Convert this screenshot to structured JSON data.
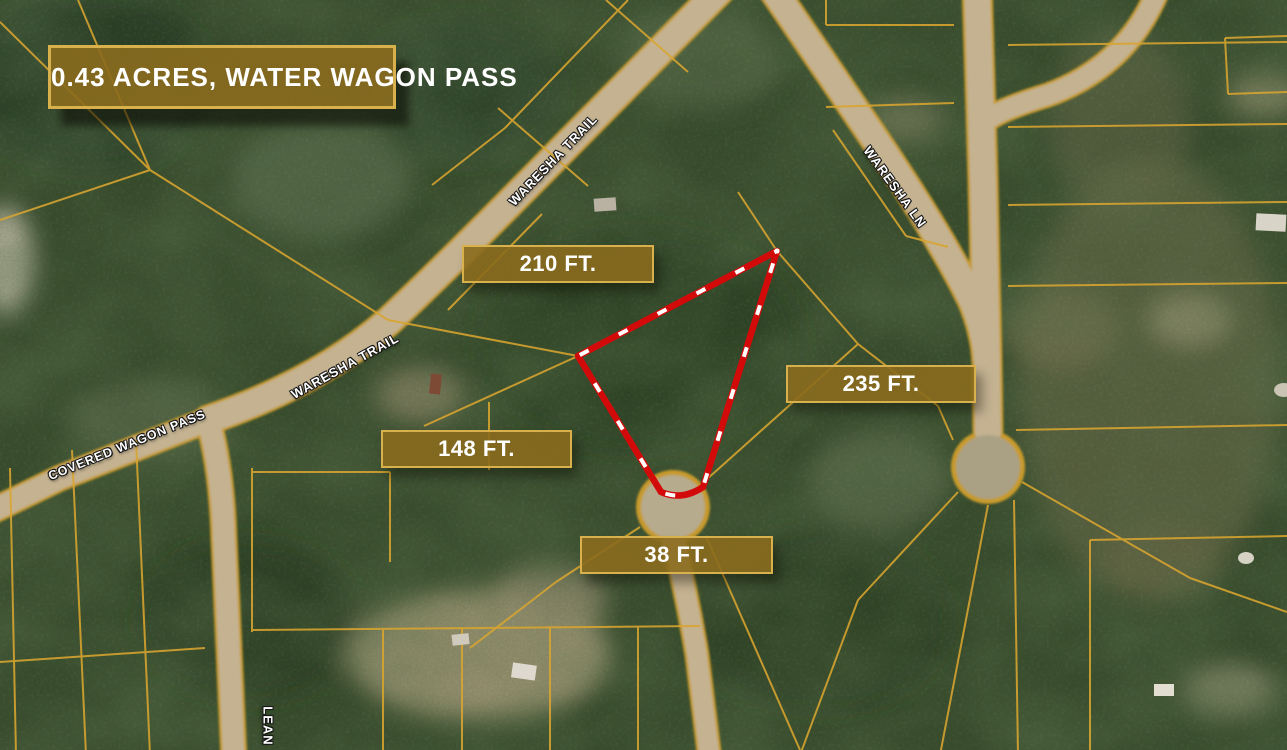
{
  "map": {
    "title": "0.43 ACRES, WATER WAGON PASS",
    "measurements": [
      {
        "label": "210 FT."
      },
      {
        "label": "235 FT."
      },
      {
        "label": "148 FT."
      },
      {
        "label": "38 FT."
      }
    ],
    "streets": [
      {
        "name": "WARESHA TRAIL"
      },
      {
        "name": "WARESHA TRAIL"
      },
      {
        "name": "WARESHA LN"
      },
      {
        "name": "COVERED WAGON PASS"
      },
      {
        "name": "LEAN"
      }
    ],
    "lot": {
      "area_acres": "0.43",
      "frontage_street": "Water Wagon Pass",
      "side_lengths_ft": [
        210,
        235,
        148,
        38
      ]
    },
    "colors": {
      "badge_background": "#8b6c1e",
      "badge_border": "#d8b14c",
      "parcel_line": "#d9a52f",
      "lot_outline_red": "#d20a0a",
      "lot_dash_white": "#ffffff",
      "road_tan": "#c4b291",
      "forest_green": "#384c2d"
    }
  }
}
